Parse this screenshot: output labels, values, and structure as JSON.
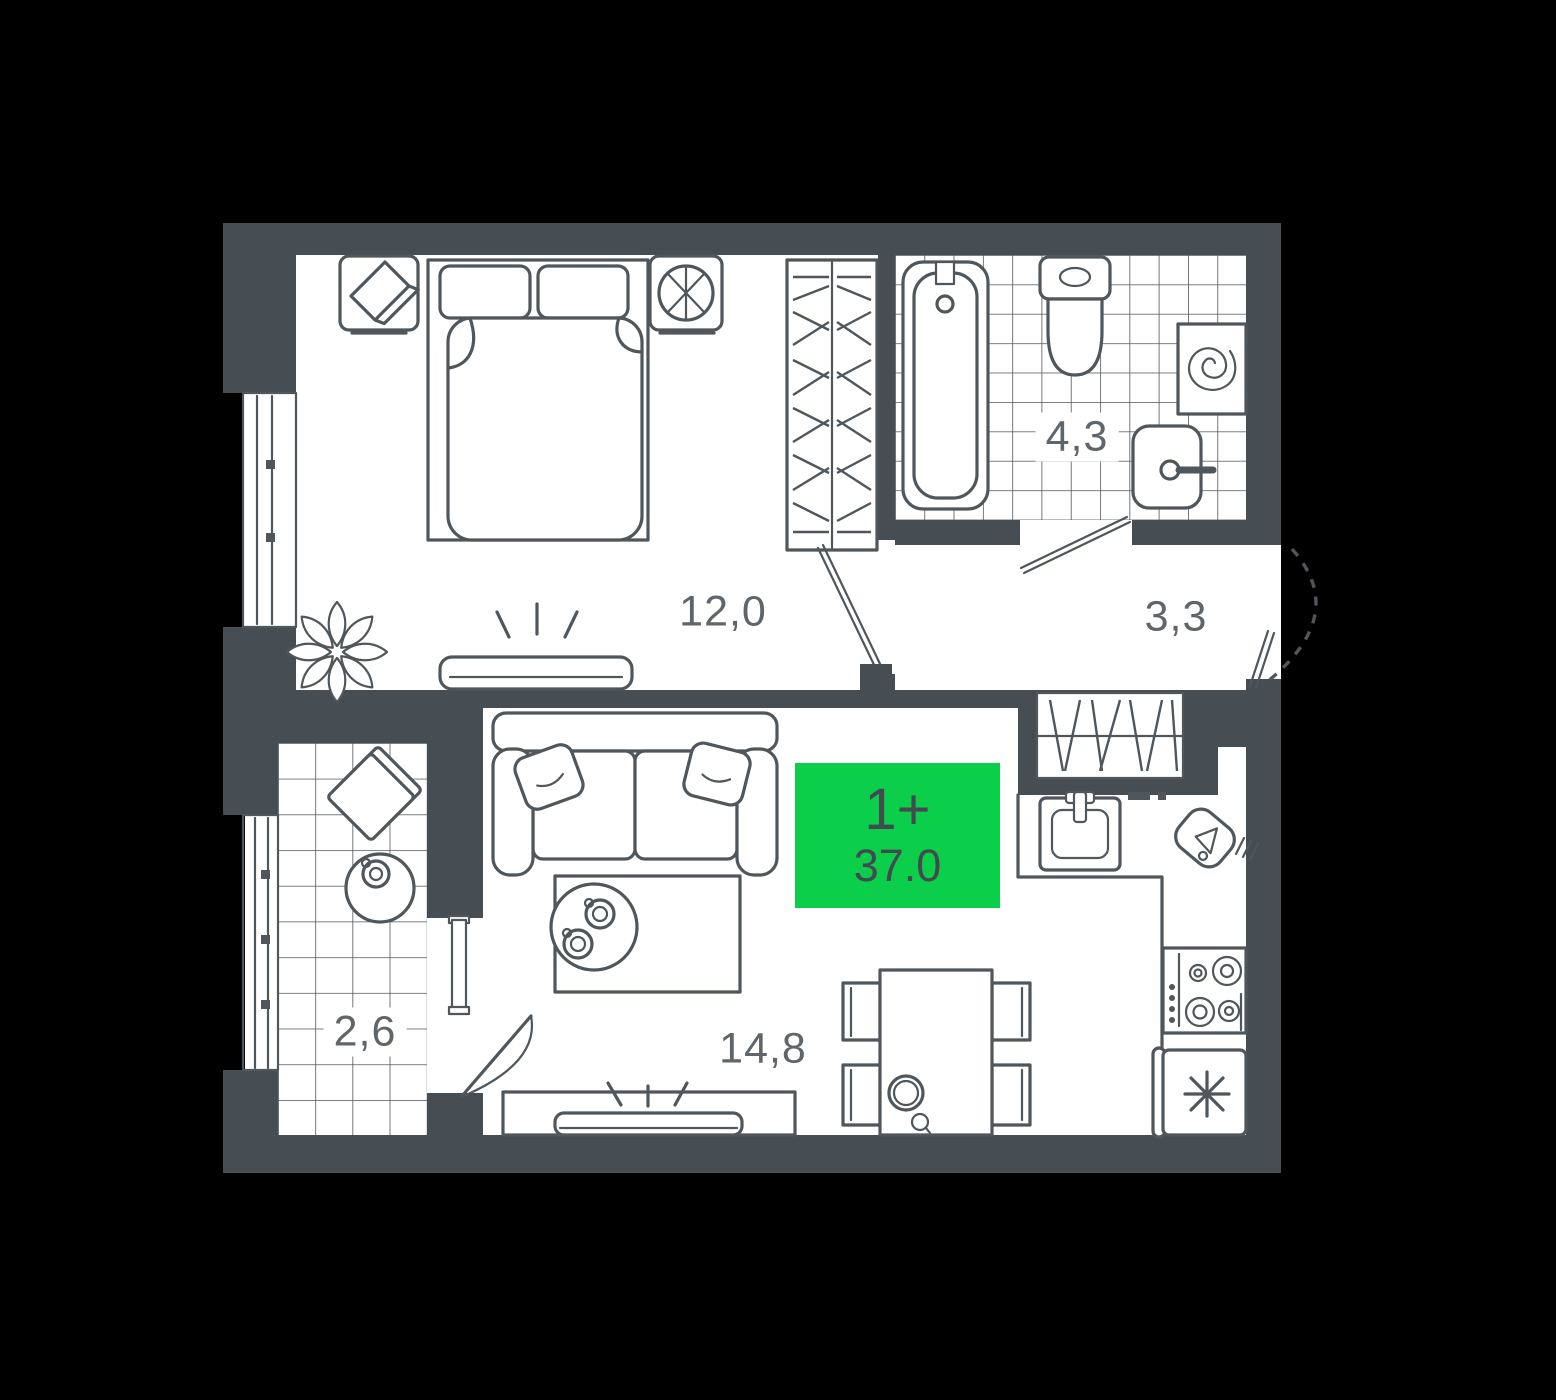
{
  "plan": {
    "badge": {
      "rooms_count_label": "1+",
      "total_area": "37.0"
    },
    "rooms": [
      {
        "name": "bedroom",
        "area": "12,0"
      },
      {
        "name": "bathroom",
        "area": "4,3"
      },
      {
        "name": "hallway",
        "area": "3,3"
      },
      {
        "name": "balcony",
        "area": "2,6"
      },
      {
        "name": "living-kitchen",
        "area": "14,8"
      }
    ],
    "colors": {
      "background": "#000000",
      "wall": "#464D53",
      "floor": "#FFFFFF",
      "line": "#4F565C",
      "accent_green": "#0BCF4B",
      "label_text": "#5F656A",
      "badge_text": "#424A50"
    }
  }
}
